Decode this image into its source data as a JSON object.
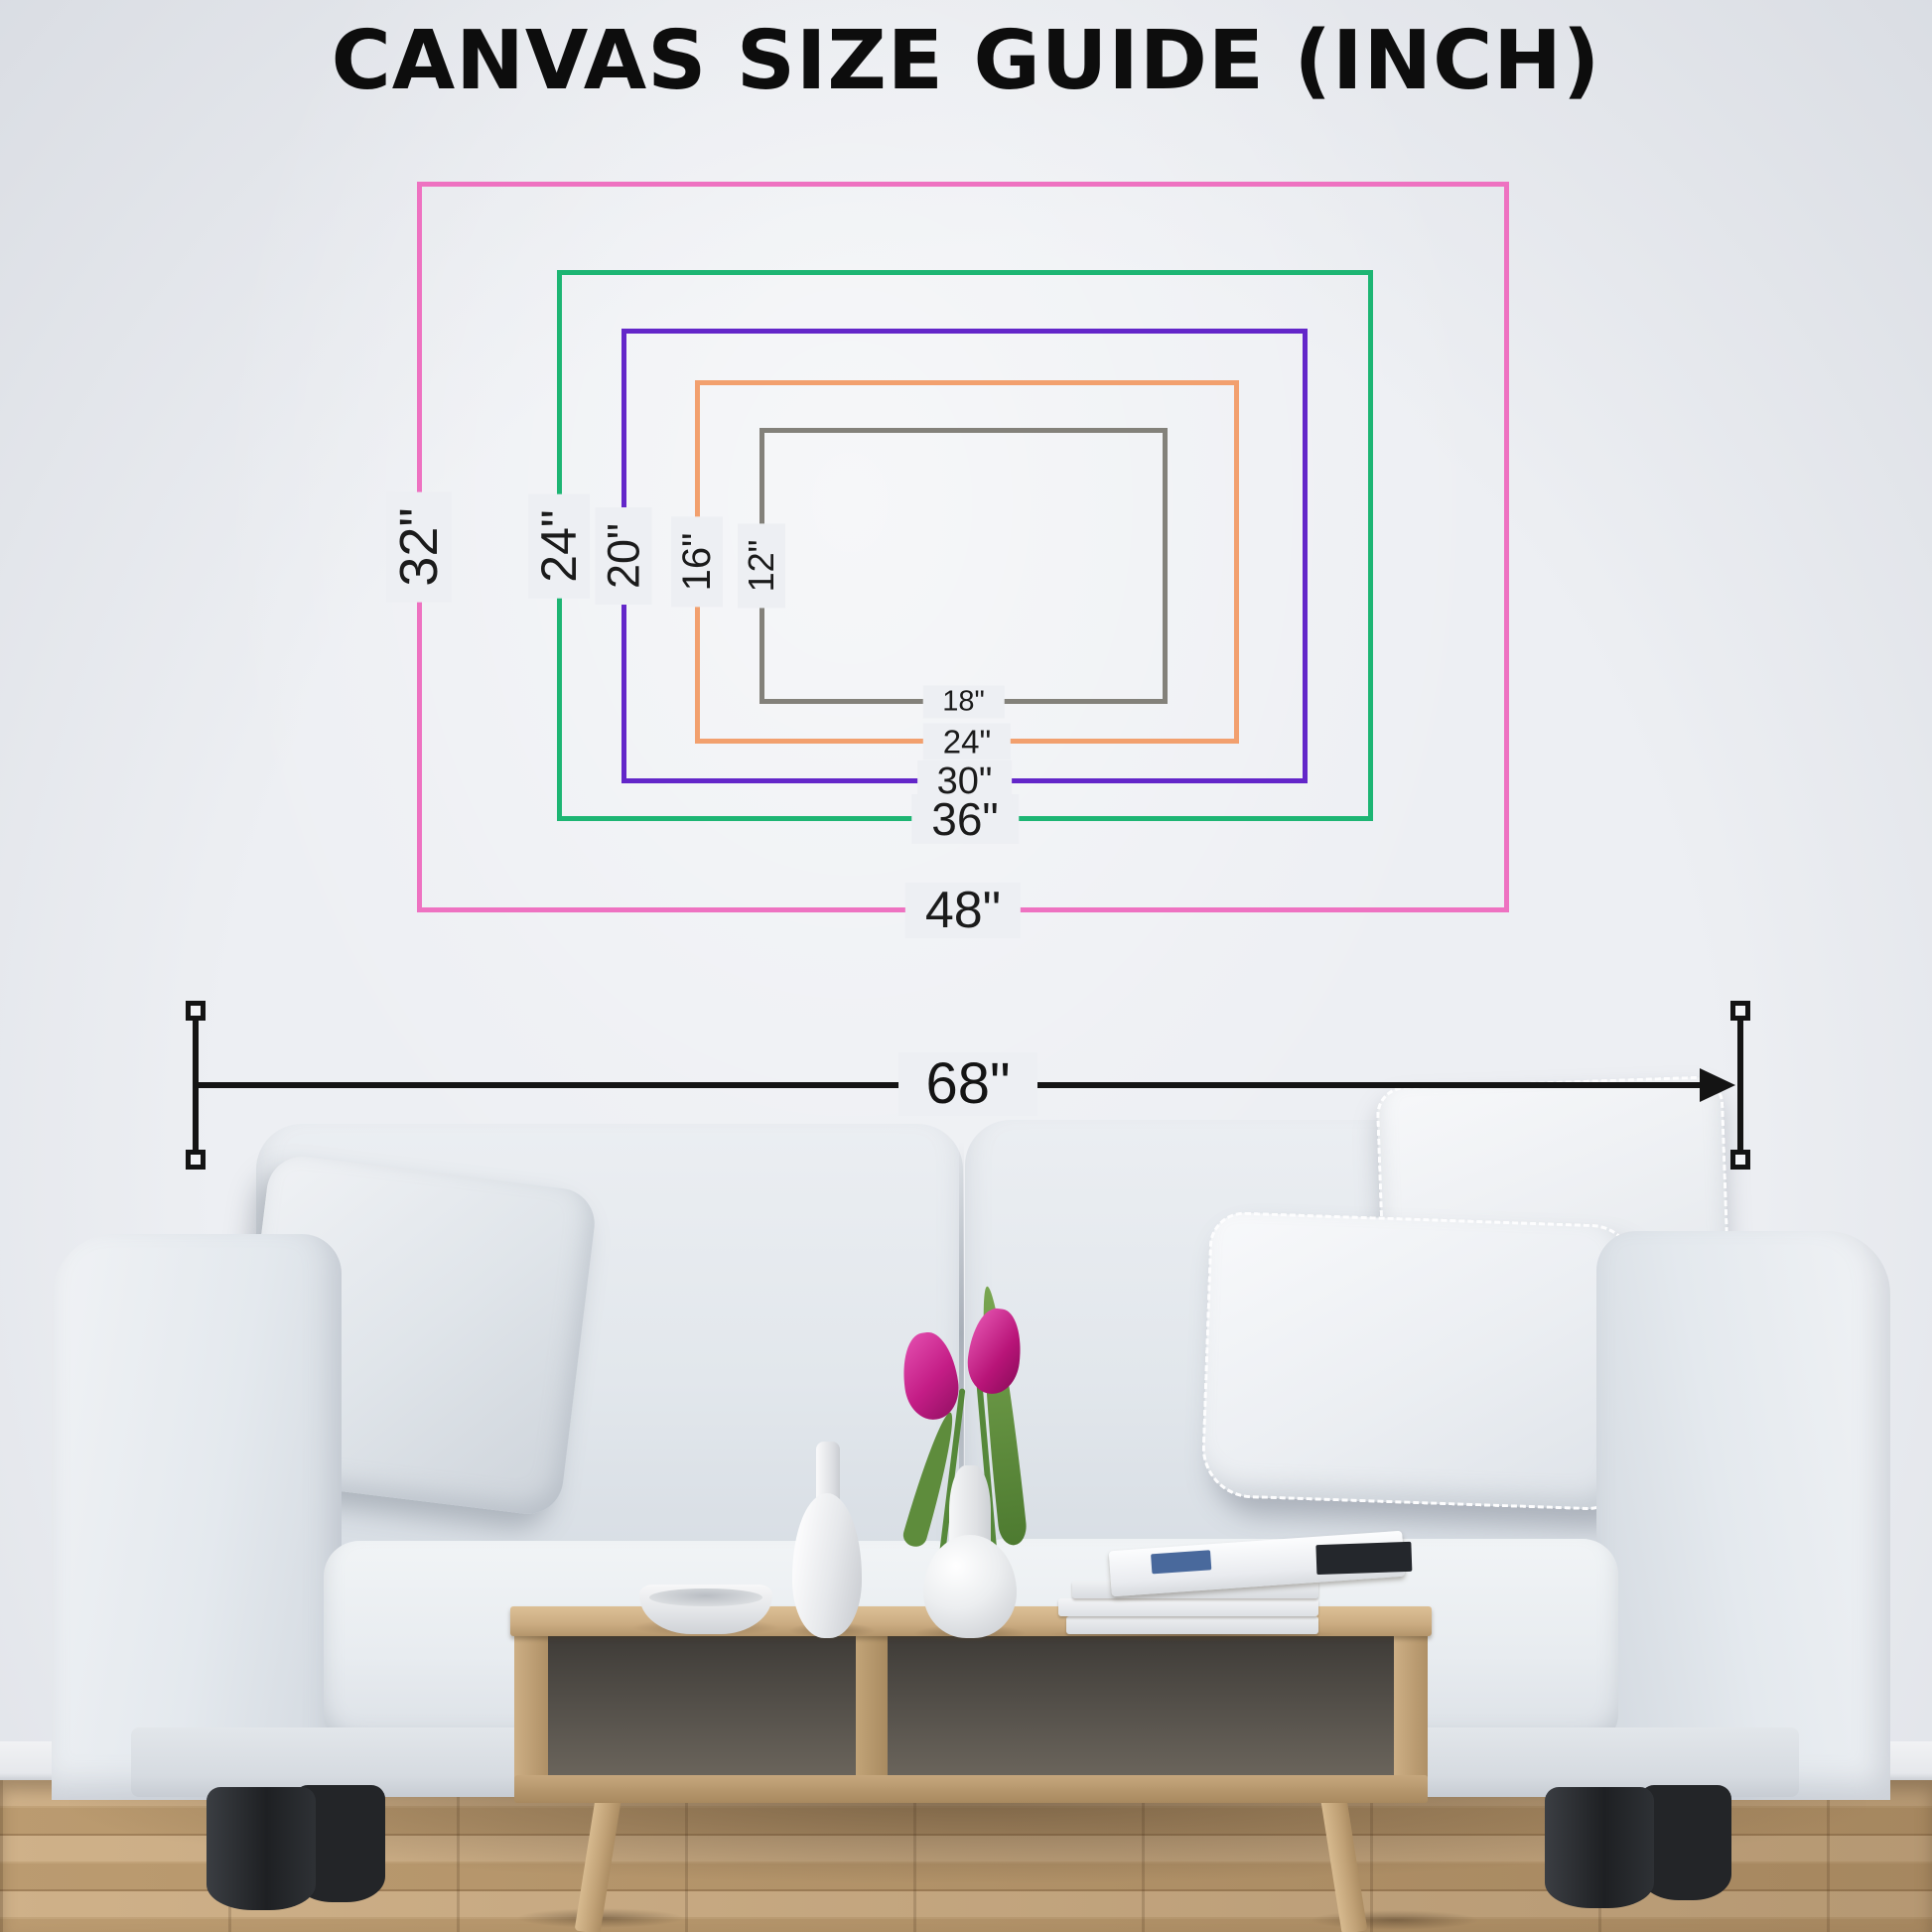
{
  "title": "CANVAS SIZE GUIDE (INCH)",
  "size_guide": {
    "rectangles": [
      {
        "id": "48x32",
        "width_label": "48\"",
        "height_label": "32\"",
        "color": "#ee72c1"
      },
      {
        "id": "36x24",
        "width_label": "36\"",
        "height_label": "24\"",
        "color": "#1db573"
      },
      {
        "id": "30x20",
        "width_label": "30\"",
        "height_label": "20\"",
        "color": "#6326c9"
      },
      {
        "id": "24x16",
        "width_label": "24\"",
        "height_label": "16\"",
        "color": "#f2a06e"
      },
      {
        "id": "18x12",
        "width_label": "18\"",
        "height_label": "12\"",
        "color": "#83817a"
      }
    ]
  },
  "wall_measurement": {
    "label": "68\"",
    "color": "#141414"
  },
  "scene": {
    "colors": {
      "wall": "#edeff3",
      "floor_wood": "#c3a379",
      "sofa_fabric": "#e7ebef",
      "table_wood": "#c9ab81",
      "tulip_pink": "#c41d86",
      "leaf_green": "#5e8f3d"
    }
  }
}
